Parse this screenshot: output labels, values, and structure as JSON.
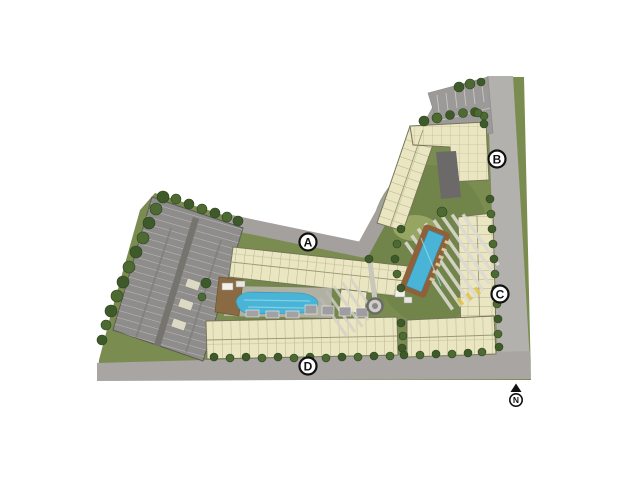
{
  "plan": {
    "kind": "residential condominium site plan",
    "markers": {
      "a": "A",
      "b": "B",
      "c": "C",
      "d": "D"
    },
    "compass": {
      "north_label": "N"
    }
  },
  "colors": {
    "background": "#ffffff",
    "site_green": "#7b8c50",
    "site_green_dark": "#6b7e45",
    "tree_green": "#3e5a2a",
    "tree_green_light": "#4e6a33",
    "road_gray": "#a8a5a2",
    "road_gray_light": "#b3b1ae",
    "access_road_gray": "#a3a09e",
    "parking_lot_gray": "#9c9a98",
    "parking_structure_gray": "#8e8d8b",
    "building_cream": "#eae6c2",
    "building_outline": "#76755a",
    "building_line": "#a8a585",
    "pool_blue": "#49b4d6",
    "pool_highlight": "#8fd7ea",
    "pool_deck_brown": "#8f613b",
    "clubhouse_brown": "#8a6a43",
    "marker_bg": "#ffffff",
    "marker_border": "#111111",
    "compass_black": "#111111"
  }
}
